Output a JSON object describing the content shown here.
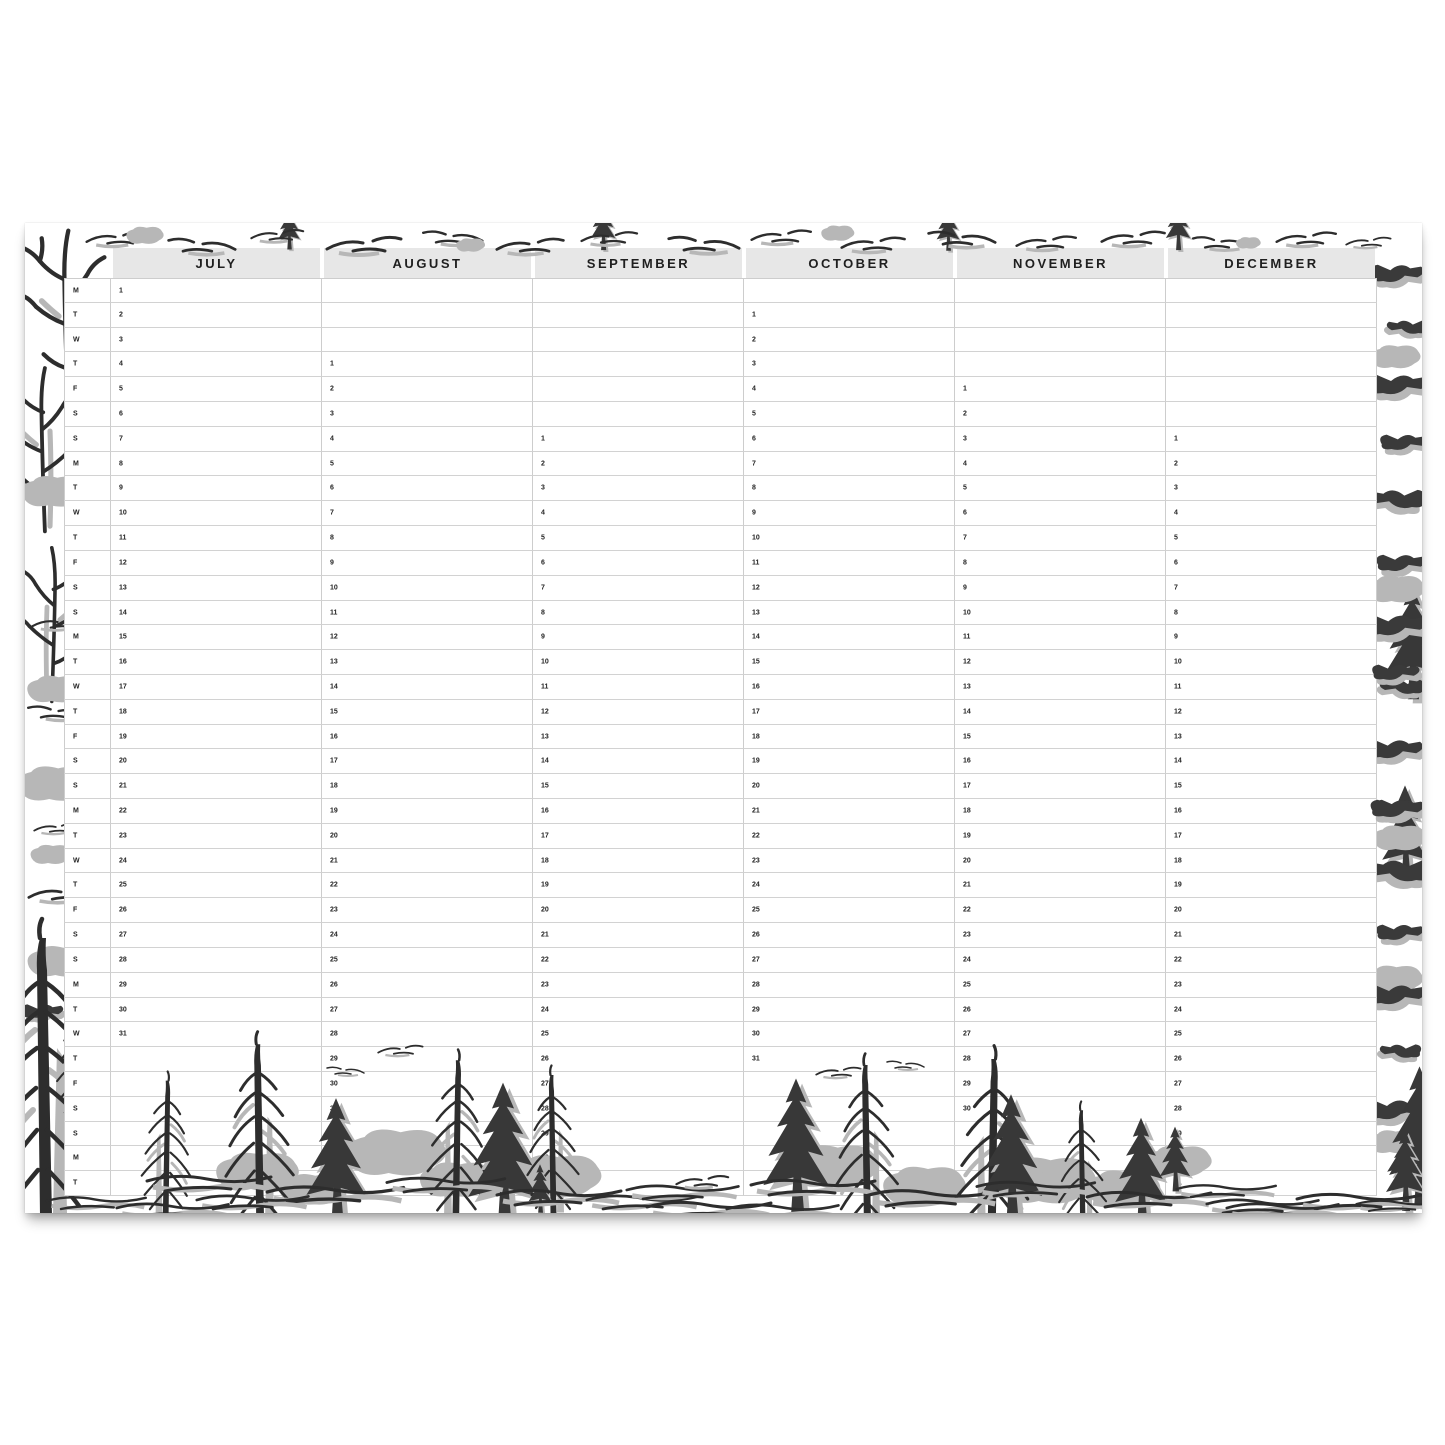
{
  "planner": {
    "row_count": 37,
    "weekday_letters": [
      "M",
      "T",
      "W",
      "T",
      "F",
      "S",
      "S",
      "M",
      "T",
      "W",
      "T",
      "F",
      "S",
      "S",
      "M",
      "T",
      "W",
      "T",
      "F",
      "S",
      "S",
      "M",
      "T",
      "W",
      "T",
      "F",
      "S",
      "S",
      "M",
      "T",
      "W",
      "T",
      "F",
      "S",
      "S",
      "M",
      "T"
    ],
    "months": [
      {
        "name": "JULY",
        "start_row": 0,
        "day_numbers": [
          1,
          2,
          3,
          4,
          5,
          6,
          7,
          8,
          9,
          10,
          11,
          12,
          13,
          14,
          15,
          16,
          17,
          18,
          19,
          20,
          21,
          22,
          23,
          24,
          25,
          26,
          27,
          28,
          29,
          30,
          31
        ]
      },
      {
        "name": "AUGUST",
        "start_row": 3,
        "day_numbers": [
          1,
          2,
          3,
          4,
          5,
          6,
          7,
          8,
          9,
          10,
          11,
          12,
          13,
          14,
          15,
          16,
          17,
          18,
          19,
          20,
          21,
          22,
          23,
          24,
          25,
          26,
          27,
          28,
          29,
          30,
          31
        ]
      },
      {
        "name": "SEPTEMBER",
        "start_row": 6,
        "day_numbers": [
          1,
          2,
          3,
          4,
          5,
          6,
          7,
          8,
          9,
          10,
          11,
          12,
          13,
          14,
          15,
          16,
          17,
          18,
          19,
          20,
          21,
          22,
          23,
          24,
          25,
          26,
          27,
          28,
          29,
          30
        ]
      },
      {
        "name": "OCTOBER",
        "start_row": 1,
        "day_numbers": [
          1,
          2,
          3,
          4,
          5,
          6,
          7,
          8,
          9,
          10,
          11,
          12,
          13,
          14,
          15,
          16,
          17,
          18,
          19,
          20,
          21,
          22,
          23,
          24,
          25,
          26,
          27,
          28,
          29,
          30,
          31
        ]
      },
      {
        "name": "NOVEMBER",
        "start_row": 4,
        "day_numbers": [
          1,
          2,
          3,
          4,
          5,
          6,
          7,
          8,
          9,
          10,
          11,
          12,
          13,
          14,
          15,
          16,
          17,
          18,
          19,
          20,
          21,
          22,
          23,
          24,
          25,
          26,
          27,
          28,
          29,
          30
        ]
      },
      {
        "name": "DECEMBER",
        "start_row": 6,
        "day_numbers": [
          1,
          2,
          3,
          4,
          5,
          6,
          7,
          8,
          9,
          10,
          11,
          12,
          13,
          14,
          15,
          16,
          17,
          18,
          19,
          20,
          21,
          22,
          23,
          24,
          25,
          26,
          27,
          28,
          29,
          30,
          31
        ]
      }
    ]
  },
  "colors": {
    "paper": "#ffffff",
    "header_bg": "#e7e7e7",
    "grid_line": "#cdcdcd",
    "text": "#1f1f1f",
    "sketch_dark": "#2d2d2d",
    "sketch_gray": "#b7b7b7"
  }
}
